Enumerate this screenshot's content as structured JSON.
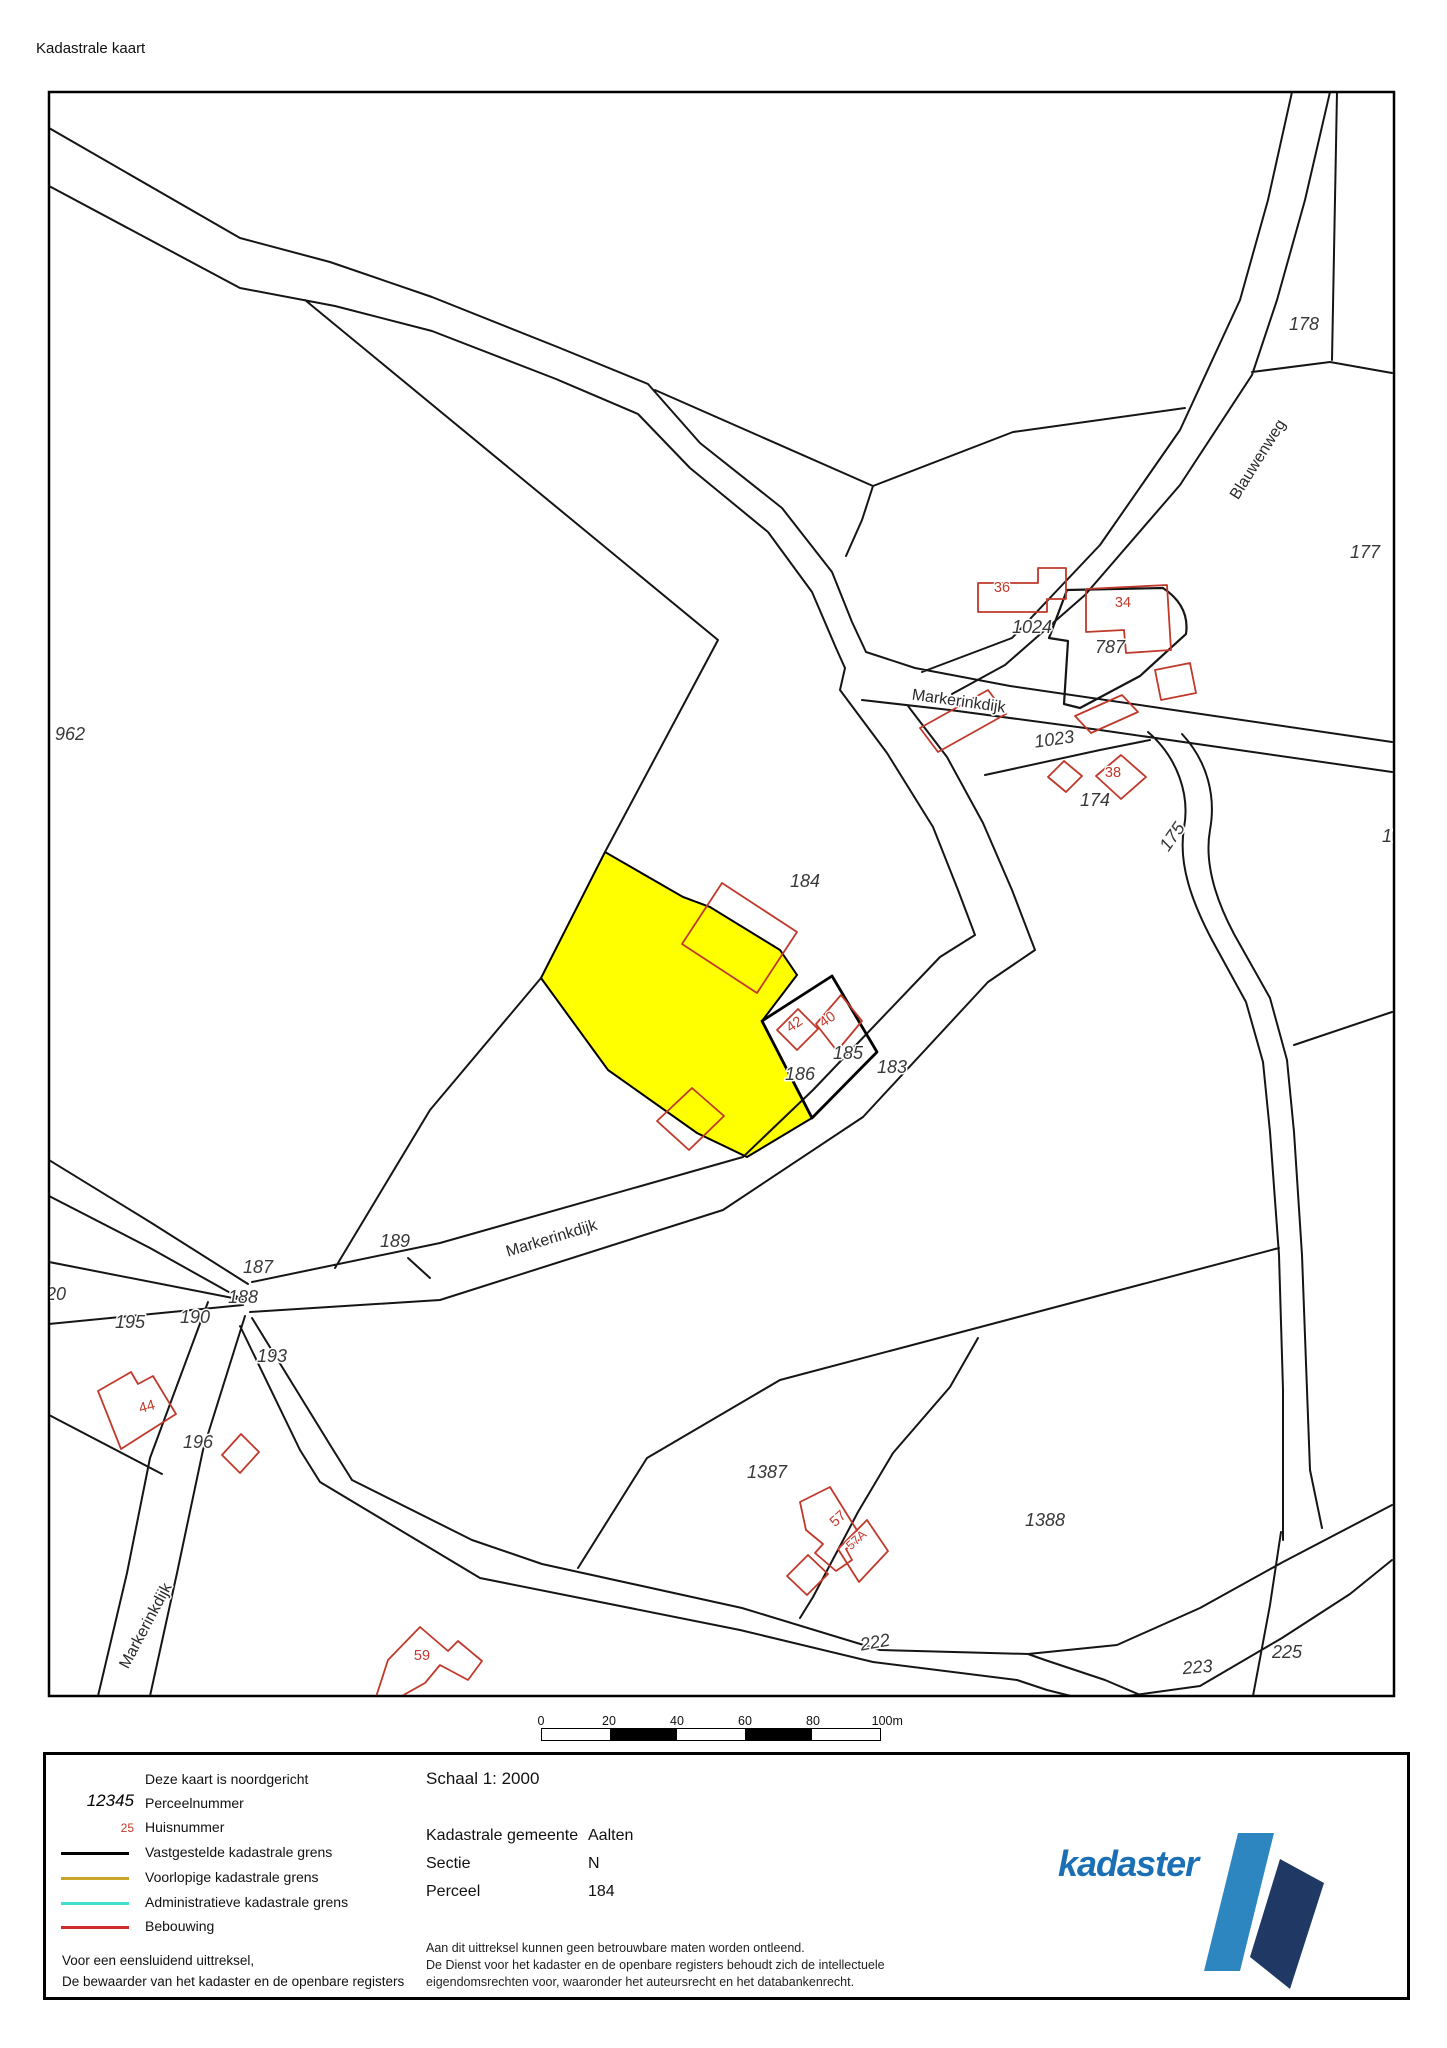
{
  "header": {
    "title": "Kadastrale kaart"
  },
  "map": {
    "selected_parcel": "184",
    "selected_parcel_color": "#ffff00",
    "boundary_color": "#151515",
    "building_color": "#c0392b",
    "labels": [
      {
        "t": "962",
        "x": 70,
        "y": 740,
        "r": 0,
        "c": "p"
      },
      {
        "t": "178",
        "x": 1304,
        "y": 330,
        "r": 0,
        "c": "p"
      },
      {
        "t": "177",
        "x": 1365,
        "y": 558,
        "r": 0,
        "c": "p"
      },
      {
        "t": "17",
        "x": 1392,
        "y": 842,
        "r": 0,
        "c": "p"
      },
      {
        "t": "1024",
        "x": 1032,
        "y": 633,
        "r": 0,
        "c": "p"
      },
      {
        "t": "787",
        "x": 1110,
        "y": 653,
        "r": 0,
        "c": "p"
      },
      {
        "t": "1023",
        "x": 1055,
        "y": 745,
        "r": -8,
        "c": "p"
      },
      {
        "t": "174",
        "x": 1095,
        "y": 806,
        "r": 0,
        "c": "p"
      },
      {
        "t": "175",
        "x": 1177,
        "y": 840,
        "r": -55,
        "c": "p"
      },
      {
        "t": "184",
        "x": 805,
        "y": 887,
        "r": 0,
        "c": "p"
      },
      {
        "t": "185",
        "x": 848,
        "y": 1059,
        "r": 0,
        "c": "p"
      },
      {
        "t": "186",
        "x": 800,
        "y": 1080,
        "r": 0,
        "c": "p"
      },
      {
        "t": "183",
        "x": 892,
        "y": 1073,
        "r": 0,
        "c": "p"
      },
      {
        "t": "189",
        "x": 395,
        "y": 1247,
        "r": 0,
        "c": "p"
      },
      {
        "t": "187",
        "x": 258,
        "y": 1273,
        "r": 0,
        "c": "p"
      },
      {
        "t": "188",
        "x": 243,
        "y": 1303,
        "r": 0,
        "c": "p"
      },
      {
        "t": "20",
        "x": 56,
        "y": 1300,
        "r": 0,
        "c": "p"
      },
      {
        "t": "195",
        "x": 130,
        "y": 1328,
        "r": 0,
        "c": "p"
      },
      {
        "t": "190",
        "x": 195,
        "y": 1323,
        "r": 0,
        "c": "p"
      },
      {
        "t": "193",
        "x": 272,
        "y": 1362,
        "r": 0,
        "c": "p"
      },
      {
        "t": "196",
        "x": 198,
        "y": 1448,
        "r": 0,
        "c": "p"
      },
      {
        "t": "1387",
        "x": 767,
        "y": 1478,
        "r": 0,
        "c": "p"
      },
      {
        "t": "1388",
        "x": 1045,
        "y": 1526,
        "r": 0,
        "c": "p"
      },
      {
        "t": "222",
        "x": 876,
        "y": 1648,
        "r": -10,
        "c": "p"
      },
      {
        "t": "223",
        "x": 1198,
        "y": 1673,
        "r": -5,
        "c": "p"
      },
      {
        "t": "225",
        "x": 1287,
        "y": 1658,
        "r": 0,
        "c": "p"
      },
      {
        "t": "36",
        "x": 1002,
        "y": 592,
        "r": 0,
        "c": "h"
      },
      {
        "t": "34",
        "x": 1123,
        "y": 607,
        "r": 0,
        "c": "h"
      },
      {
        "t": "38",
        "x": 1113,
        "y": 777,
        "r": 0,
        "c": "h"
      },
      {
        "t": "42",
        "x": 797,
        "y": 1028,
        "r": -35,
        "c": "h"
      },
      {
        "t": "40",
        "x": 830,
        "y": 1023,
        "r": -35,
        "c": "h"
      },
      {
        "t": "44",
        "x": 148,
        "y": 1411,
        "r": -15,
        "c": "h"
      },
      {
        "t": "57",
        "x": 841,
        "y": 1522,
        "r": -42,
        "c": "h"
      },
      {
        "t": "57A",
        "x": 859,
        "y": 1543,
        "r": -42,
        "c": "h hs"
      },
      {
        "t": "59",
        "x": 422,
        "y": 1660,
        "r": 0,
        "c": "h"
      },
      {
        "t": "Blauwenweg",
        "x": 1262,
        "y": 462,
        "r": -58,
        "c": "r"
      },
      {
        "t": "Markerinkdijk",
        "x": 958,
        "y": 706,
        "r": 8,
        "c": "r"
      },
      {
        "t": "Markerinkdijk",
        "x": 553,
        "y": 1243,
        "r": -17,
        "c": "r"
      },
      {
        "t": "Markerinkdijk",
        "x": 150,
        "y": 1628,
        "r": -62,
        "c": "r"
      }
    ]
  },
  "scalebar": {
    "labels": [
      "0",
      "20",
      "40",
      "60",
      "80",
      "100m"
    ]
  },
  "legend": {
    "north_note": "Deze kaart is noordgericht",
    "parcel_sample": "12345",
    "parcel_label": "Perceelnummer",
    "house_sample": "25",
    "house_label": "Huisnummer",
    "lines": [
      {
        "label": "Vastgestelde kadastrale grens",
        "color": "#000000"
      },
      {
        "label": "Voorlopige kadastrale grens",
        "color": "#c8a428"
      },
      {
        "label": "Administratieve kadastrale grens",
        "color": "#40e0d0"
      },
      {
        "label": "Bebouwing",
        "color": "#d22b2b"
      }
    ],
    "footer_line1": "Voor een eensluidend uittreksel,",
    "footer_line2": "De bewaarder van het kadaster en de openbare registers",
    "scale_text": "Schaal 1: 2000",
    "fields": [
      {
        "label": "Kadastrale gemeente",
        "value": "Aalten"
      },
      {
        "label": "Sectie",
        "value": "N"
      },
      {
        "label": "Perceel",
        "value": "184"
      }
    ],
    "disclaimer": [
      "Aan dit uittreksel kunnen geen betrouwbare maten worden ontleend.",
      "De Dienst voor het kadaster en de openbare registers behoudt zich de intellectuele",
      "eigendomsrechten voor, waaronder het auteursrecht en het databankenrecht."
    ],
    "logo_text": "kadaster",
    "logo_light_color": "#2e86c1",
    "logo_dark_color": "#1f3864",
    "logo_text_color": "#1a6fb5"
  }
}
